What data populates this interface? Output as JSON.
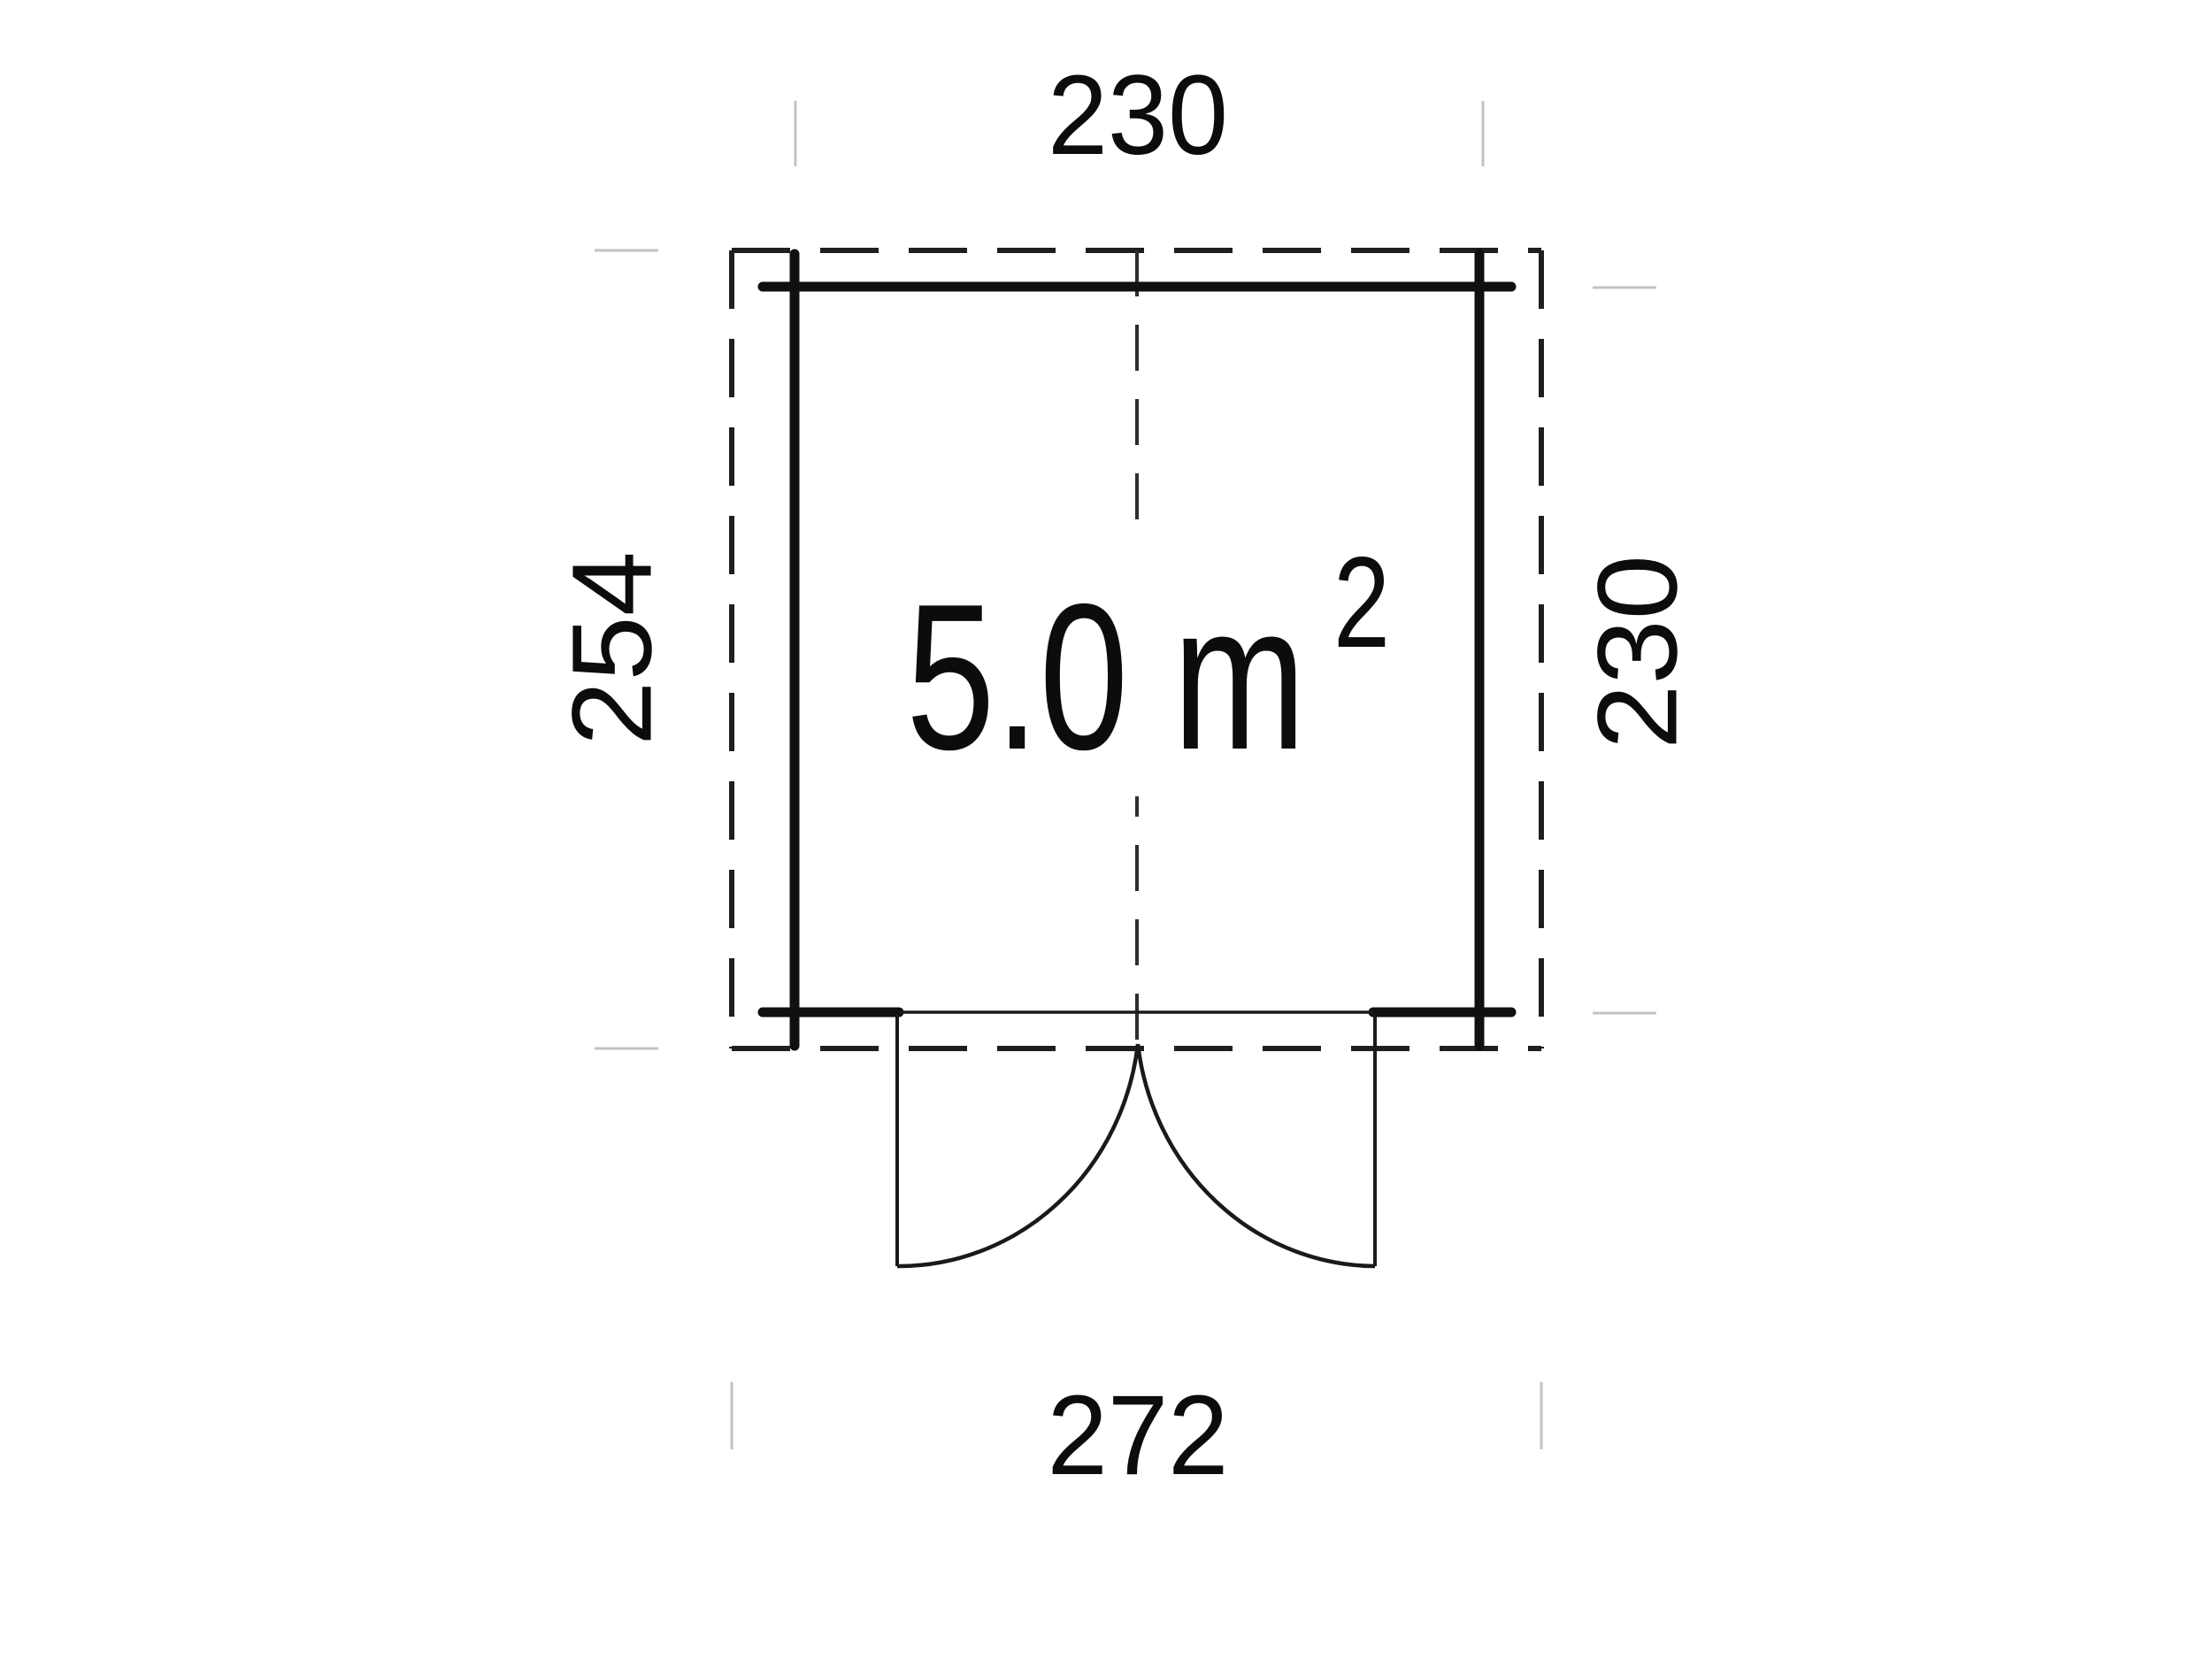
{
  "plan": {
    "dim_top": "230",
    "dim_bottom": "272",
    "dim_left": "254",
    "dim_right": "230",
    "area_value": "5.0 m",
    "area_exponent": "2"
  },
  "colors": {
    "background": "#ffffff",
    "wall": "#101010",
    "outline_dash": "#1f1f1f",
    "center_line": "#2e2e2e",
    "door": "#1a1a1a",
    "tick": "#c3c3c3",
    "text": "#0c0c0c"
  }
}
